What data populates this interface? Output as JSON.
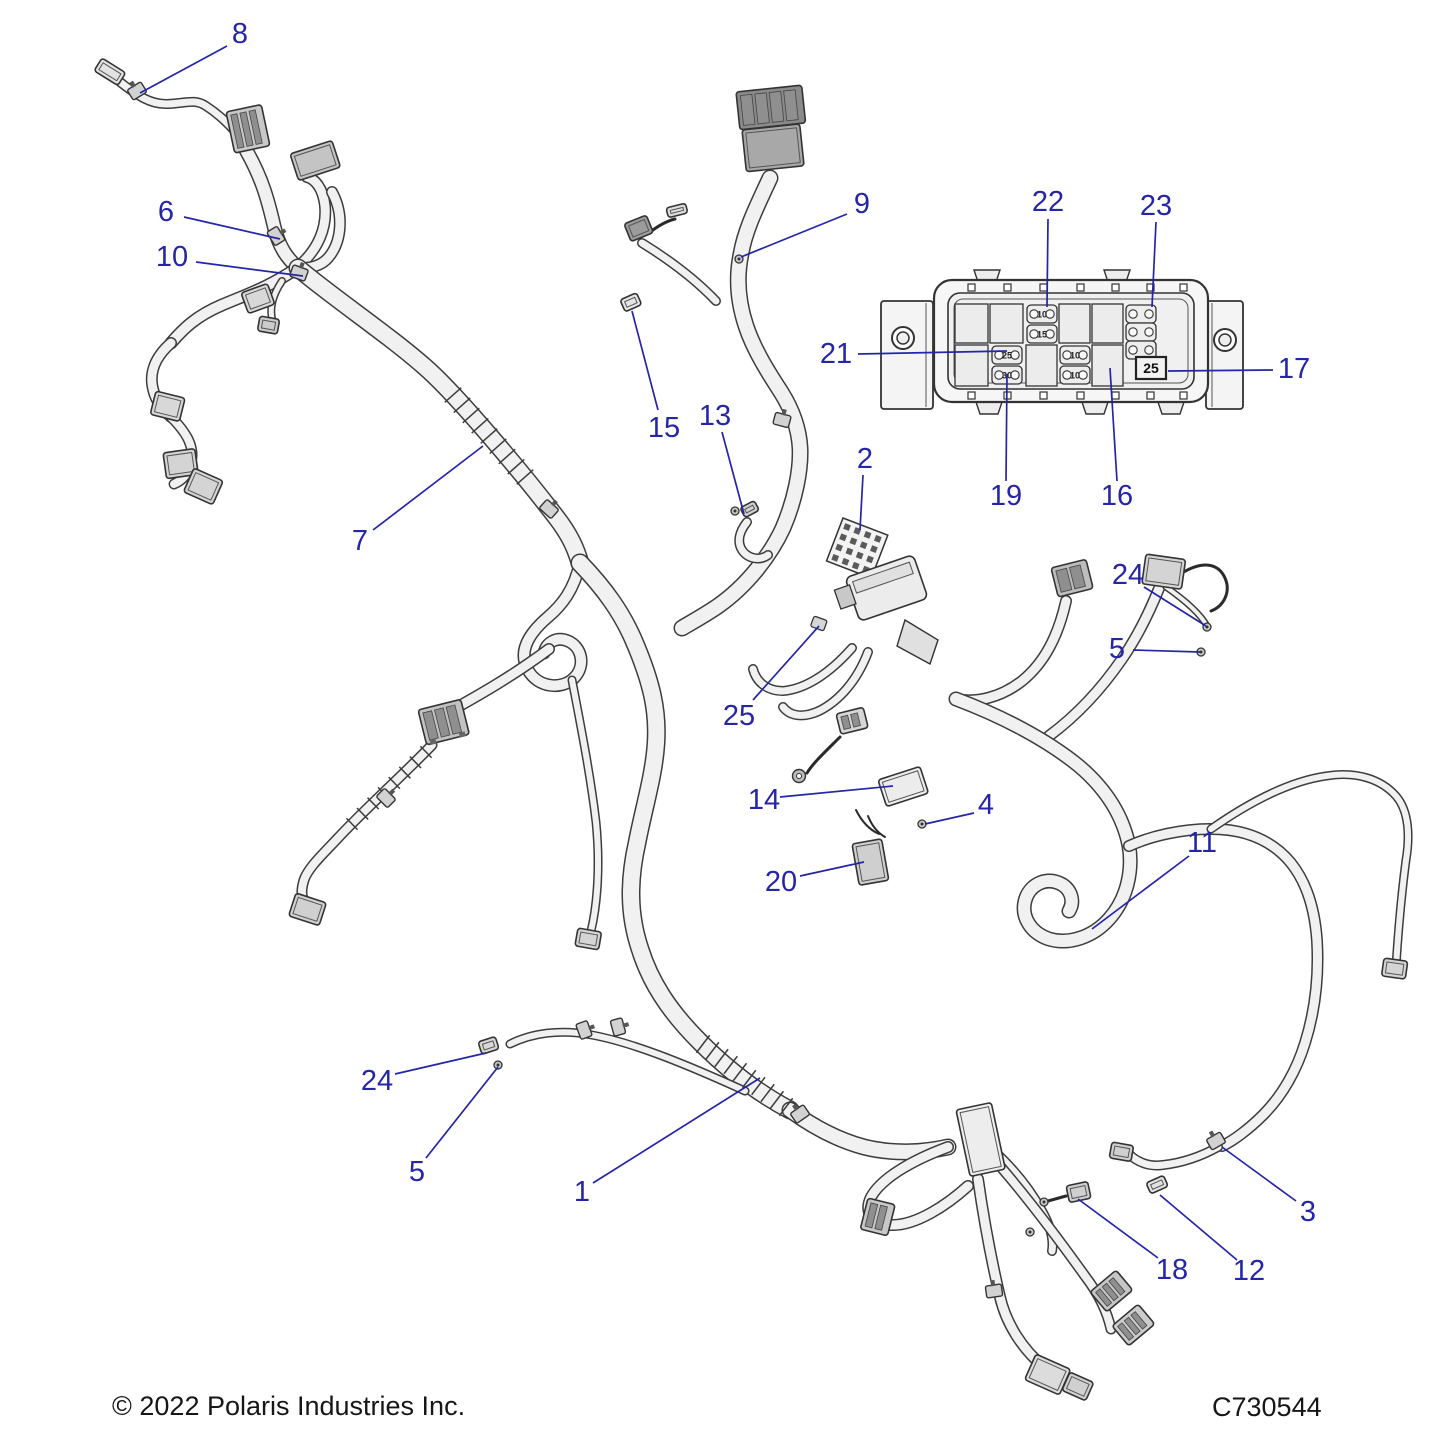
{
  "footer": {
    "copyright": "© 2022 Polaris Industries Inc.",
    "part_code": "C730544"
  },
  "style": {
    "callout_color": "#2525a8",
    "line_color": "#3d3d3d",
    "tube_fill": "#f1f1f1",
    "text_color": "#161616"
  },
  "callouts": [
    {
      "n": "8",
      "x": 240,
      "y": 34,
      "l": [
        227,
        46,
        140,
        93
      ]
    },
    {
      "n": "6",
      "x": 166,
      "y": 212,
      "l": [
        184,
        217,
        280,
        239
      ]
    },
    {
      "n": "10",
      "x": 172,
      "y": 257,
      "l": [
        196,
        262,
        303,
        276
      ]
    },
    {
      "n": "7",
      "x": 360,
      "y": 541,
      "l": [
        373,
        530,
        483,
        446
      ]
    },
    {
      "n": "15",
      "x": 664,
      "y": 428,
      "l": [
        658,
        410,
        632,
        311
      ]
    },
    {
      "n": "13",
      "x": 715,
      "y": 416,
      "l": [
        722,
        432,
        744,
        514
      ]
    },
    {
      "n": "9",
      "x": 862,
      "y": 204,
      "l": [
        847,
        214,
        741,
        257
      ]
    },
    {
      "n": "22",
      "x": 1048,
      "y": 202,
      "l": [
        1048,
        219,
        1047,
        307
      ]
    },
    {
      "n": "23",
      "x": 1156,
      "y": 206,
      "l": [
        1156,
        222,
        1152,
        307
      ]
    },
    {
      "n": "21",
      "x": 836,
      "y": 354,
      "l": [
        858,
        354,
        1007,
        351
      ]
    },
    {
      "n": "17",
      "x": 1294,
      "y": 369,
      "l": [
        1273,
        370,
        1168,
        371
      ]
    },
    {
      "n": "19",
      "x": 1006,
      "y": 496,
      "l": [
        1006,
        481,
        1007,
        374
      ]
    },
    {
      "n": "16",
      "x": 1117,
      "y": 496,
      "l": [
        1117,
        481,
        1110,
        368
      ]
    },
    {
      "n": "2",
      "x": 865,
      "y": 459,
      "l": [
        863,
        475,
        860,
        530
      ]
    },
    {
      "n": "25",
      "x": 739,
      "y": 716,
      "l": [
        753,
        700,
        819,
        626
      ]
    },
    {
      "n": "24",
      "x": 1128,
      "y": 575,
      "l": [
        1144,
        587,
        1206,
        626
      ]
    },
    {
      "n": "5",
      "x": 1117,
      "y": 649,
      "l": [
        1133,
        650,
        1200,
        652
      ]
    },
    {
      "n": "14",
      "x": 764,
      "y": 800,
      "l": [
        780,
        797,
        893,
        786
      ]
    },
    {
      "n": "4",
      "x": 986,
      "y": 805,
      "l": [
        974,
        813,
        925,
        824
      ]
    },
    {
      "n": "20",
      "x": 781,
      "y": 882,
      "l": [
        800,
        876,
        864,
        862
      ]
    },
    {
      "n": "11",
      "x": 1202,
      "y": 843,
      "l": [
        1189,
        856,
        1092,
        929
      ]
    },
    {
      "n": "24",
      "x": 377,
      "y": 1081,
      "l": [
        395,
        1074,
        486,
        1053
      ]
    },
    {
      "n": "5",
      "x": 417,
      "y": 1172,
      "l": [
        426,
        1158,
        498,
        1067
      ]
    },
    {
      "n": "1",
      "x": 582,
      "y": 1192,
      "l": [
        593,
        1183,
        760,
        1078
      ]
    },
    {
      "n": "3",
      "x": 1308,
      "y": 1212,
      "l": [
        1296,
        1201,
        1222,
        1147
      ]
    },
    {
      "n": "12",
      "x": 1249,
      "y": 1271,
      "l": [
        1237,
        1260,
        1160,
        1195
      ]
    },
    {
      "n": "18",
      "x": 1172,
      "y": 1270,
      "l": [
        1158,
        1258,
        1078,
        1199
      ]
    }
  ],
  "fusebox": {
    "mini_fuses": [
      {
        "label": "25",
        "x": 992,
        "y": 346
      },
      {
        "label": "30",
        "x": 992,
        "y": 366
      },
      {
        "label": "10",
        "x": 1027,
        "y": 305
      },
      {
        "label": "15",
        "x": 1027,
        "y": 325
      },
      {
        "label": "10",
        "x": 1060,
        "y": 346
      },
      {
        "label": "10",
        "x": 1060,
        "y": 366
      },
      {
        "label": "",
        "x": 1126,
        "y": 305
      },
      {
        "label": "",
        "x": 1126,
        "y": 323
      },
      {
        "label": "",
        "x": 1126,
        "y": 341
      }
    ],
    "boxed_fuse": {
      "label": "25",
      "x": 1136,
      "y": 357
    }
  }
}
